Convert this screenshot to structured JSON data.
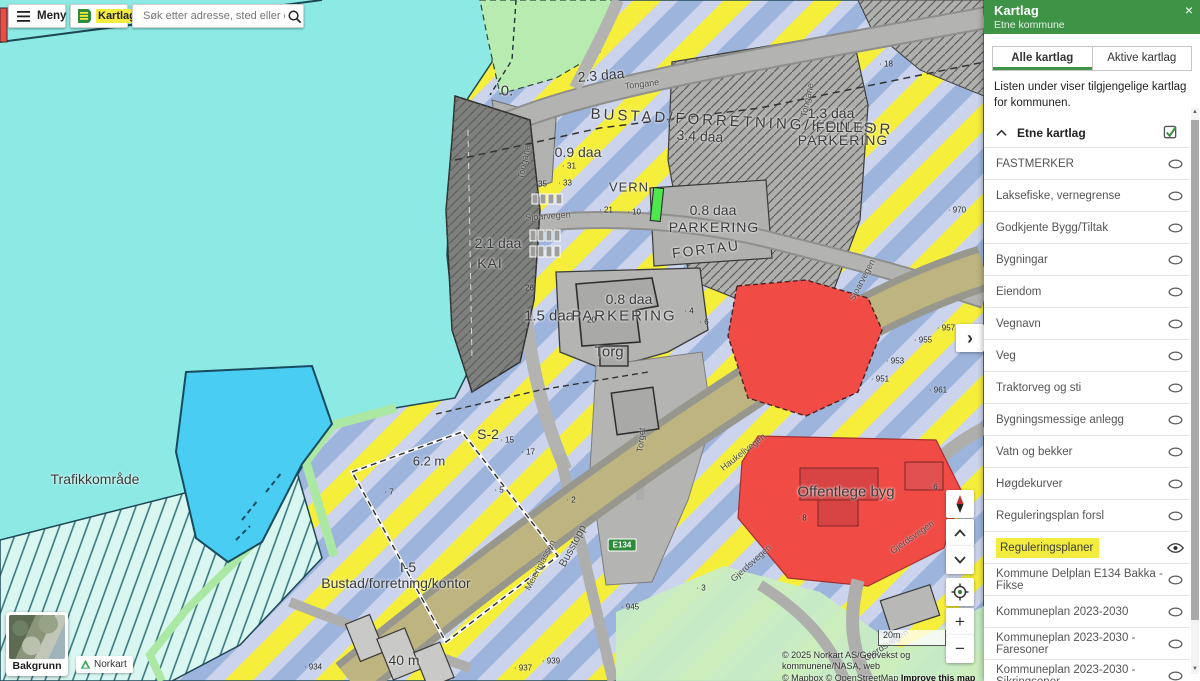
{
  "header": {
    "meny_label": "Meny",
    "kartlag_label": "Kartlag",
    "search_placeholder": "Søk etter adresse, sted eller eiendom"
  },
  "panel": {
    "title": "Kartlag",
    "subtitle": "Etne kommune",
    "close_glyph": "×",
    "tabs": [
      {
        "label": "Alle kartlag",
        "active": true
      },
      {
        "label": "Aktive kartlag",
        "active": false
      }
    ],
    "description": "Listen under viser tilgjengelige kartlag for kommunen.",
    "group_label": "Etne kartlag",
    "layers": [
      {
        "label": "FASTMERKER",
        "visible": false
      },
      {
        "label": "Laksefiske, vernegrense",
        "visible": false
      },
      {
        "label": "Godkjente Bygg/Tiltak",
        "visible": false
      },
      {
        "label": "Bygningar",
        "visible": false
      },
      {
        "label": "Eiendom",
        "visible": false
      },
      {
        "label": "Vegnavn",
        "visible": false
      },
      {
        "label": "Veg",
        "visible": false
      },
      {
        "label": "Traktorveg og sti",
        "visible": false
      },
      {
        "label": "Bygningsmessige anlegg",
        "visible": false
      },
      {
        "label": "Vatn og bekker",
        "visible": false
      },
      {
        "label": "Høgdekurver",
        "visible": false
      },
      {
        "label": "Reguleringsplan forsl",
        "visible": false
      },
      {
        "label": "Reguleringsplaner",
        "visible": true,
        "highlighted": true
      },
      {
        "label": "Kommune Delplan E134 Bakka - Fikse",
        "visible": false
      },
      {
        "label": "Kommuneplan 2023-2030",
        "visible": false
      },
      {
        "label": "Kommuneplan 2023-2030 - Faresoner",
        "visible": false
      },
      {
        "label": "Kommuneplan 2023-2030 - Sikringsoner",
        "visible": false
      }
    ]
  },
  "map": {
    "route_shield": "E134",
    "scale_label": "20m",
    "attribution_line1": "© 2025 Norkart AS/Geovekst og kommunene/NASA, web",
    "attribution_line2": "© Mapbox © OpenStreetMap ",
    "attribution_improve": "Improve this map",
    "controls": {
      "expand": "›",
      "zoom_in": "+",
      "zoom_out": "−"
    },
    "zone_labels": [
      {
        "text": "0.",
        "x": 507,
        "y": 91,
        "size": 15
      },
      {
        "text": "2.3 daa",
        "x": 601,
        "y": 75,
        "size": 14,
        "rotate": -5
      },
      {
        "text": "0.9 daa",
        "x": 578,
        "y": 152,
        "size": 14
      },
      {
        "text": "BUSTAD/FORRETNING/KONTOR",
        "x": 742,
        "y": 122,
        "size": 15,
        "rotate": 3,
        "spacing": 3
      },
      {
        "text": "3.4 daa",
        "x": 700,
        "y": 136,
        "size": 14,
        "rotate": 3
      },
      {
        "text": "1.3 daa",
        "x": 831,
        "y": 113,
        "size": 14
      },
      {
        "text": "FELLES",
        "x": 845,
        "y": 127,
        "size": 14,
        "spacing": 1
      },
      {
        "text": "PARKERING",
        "x": 843,
        "y": 140,
        "size": 14,
        "spacing": 1
      },
      {
        "text": "VERN",
        "x": 629,
        "y": 187,
        "size": 13,
        "spacing": 1
      },
      {
        "text": "0.8 daa",
        "x": 713,
        "y": 210,
        "size": 14
      },
      {
        "text": "PARKERING",
        "x": 714,
        "y": 227,
        "size": 14,
        "spacing": 1
      },
      {
        "text": "FORTAU",
        "x": 706,
        "y": 249,
        "size": 14,
        "rotate": -7,
        "spacing": 2
      },
      {
        "text": "2.1 daa",
        "x": 498,
        "y": 243,
        "size": 14
      },
      {
        "text": "KAI",
        "x": 490,
        "y": 263,
        "size": 14,
        "spacing": 1
      },
      {
        "text": "1.5 daa",
        "x": 549,
        "y": 316,
        "size": 15
      },
      {
        "text": "0.8 daa",
        "x": 629,
        "y": 299,
        "size": 14
      },
      {
        "text": "PARKERING",
        "x": 624,
        "y": 316,
        "size": 15,
        "spacing": 2
      },
      {
        "text": "Torg",
        "x": 609,
        "y": 352,
        "size": 15
      },
      {
        "text": "S-2",
        "x": 488,
        "y": 434,
        "size": 14
      },
      {
        "text": "6.2 m",
        "x": 429,
        "y": 461,
        "size": 13
      },
      {
        "text": "Trafikkområde",
        "x": 95,
        "y": 479,
        "size": 14
      },
      {
        "text": "I-5",
        "x": 408,
        "y": 567,
        "size": 14
      },
      {
        "text": "Bustad/forretning/kontor",
        "x": 396,
        "y": 583,
        "size": 14
      },
      {
        "text": "40 m",
        "x": 404,
        "y": 660,
        "size": 14
      },
      {
        "text": "Offentlege byg",
        "x": 846,
        "y": 492,
        "size": 15
      }
    ],
    "street_labels": [
      {
        "text": "Tongane",
        "x": 642,
        "y": 84,
        "rotate": -7
      },
      {
        "text": "Tongane",
        "x": 807,
        "y": 100,
        "rotate": -78
      },
      {
        "text": "Tongane",
        "x": 524,
        "y": 162,
        "rotate": -78
      },
      {
        "text": "Sjoarvegen",
        "x": 548,
        "y": 216,
        "rotate": -4
      },
      {
        "text": "Sjoarvegen",
        "x": 862,
        "y": 280,
        "rotate": -62
      },
      {
        "text": "Torget",
        "x": 641,
        "y": 440,
        "rotate": -84
      },
      {
        "text": "Haukelivegen",
        "x": 743,
        "y": 452,
        "rotate": -38
      },
      {
        "text": "Busstopp",
        "x": 573,
        "y": 546,
        "rotate": -62,
        "size": 11
      },
      {
        "text": "Meieriplassen",
        "x": 540,
        "y": 565,
        "rotate": -62
      },
      {
        "text": "Gjerdsvegen",
        "x": 912,
        "y": 537,
        "rotate": -35
      },
      {
        "text": "Gjerdsvegen",
        "x": 751,
        "y": 563,
        "rotate": -42
      },
      {
        "text": "Gjerdsvegen",
        "x": 886,
        "y": 645,
        "rotate": -33
      }
    ],
    "point_labels": [
      {
        "text": "· 970",
        "x": 957,
        "y": 210
      },
      {
        "text": "· 957",
        "x": 946,
        "y": 328
      },
      {
        "text": "· 955",
        "x": 923,
        "y": 340
      },
      {
        "text": "· 953",
        "x": 895,
        "y": 361
      },
      {
        "text": "· 951",
        "x": 880,
        "y": 379
      },
      {
        "text": "· 961",
        "x": 938,
        "y": 390
      },
      {
        "text": "· 945",
        "x": 630,
        "y": 607
      },
      {
        "text": "· 939",
        "x": 551,
        "y": 661
      },
      {
        "text": "· 937",
        "x": 523,
        "y": 668
      },
      {
        "text": "· 934",
        "x": 313,
        "y": 667
      },
      {
        "text": "· 18",
        "x": 886,
        "y": 64
      },
      {
        "text": "· 31",
        "x": 569,
        "y": 166
      },
      {
        "text": "· 35",
        "x": 540,
        "y": 184
      },
      {
        "text": "· 33",
        "x": 565,
        "y": 183
      },
      {
        "text": "· 21",
        "x": 606,
        "y": 210
      },
      {
        "text": "· 10",
        "x": 634,
        "y": 212
      },
      {
        "text": "· 26",
        "x": 527,
        "y": 288
      },
      {
        "text": "· 20",
        "x": 589,
        "y": 320
      },
      {
        "text": "· 4",
        "x": 689,
        "y": 311
      },
      {
        "text": "· 6",
        "x": 704,
        "y": 322
      },
      {
        "text": "· 15",
        "x": 507,
        "y": 440
      },
      {
        "text": "· 17",
        "x": 528,
        "y": 452
      },
      {
        "text": "· 5",
        "x": 499,
        "y": 490
      },
      {
        "text": "· 2",
        "x": 571,
        "y": 500
      },
      {
        "text": "· 7",
        "x": 389,
        "y": 492
      },
      {
        "text": "· 3",
        "x": 701,
        "y": 588
      },
      {
        "text": "· 8",
        "x": 802,
        "y": 518
      },
      {
        "text": "· 6",
        "x": 933,
        "y": 487
      }
    ]
  },
  "footer": {
    "background_label": "Bakgrunn",
    "norkart_label": "Norkart"
  },
  "colors": {
    "brand_green": "#3E9346",
    "highlight_yellow": "#F3EC3E",
    "water": "#8DE9E4",
    "zone_yellow": "#F5EE3B",
    "zone_blue": "#9DB4DC",
    "zone_red": "#F04B45",
    "harbor_blue": "#4ACDF2"
  }
}
